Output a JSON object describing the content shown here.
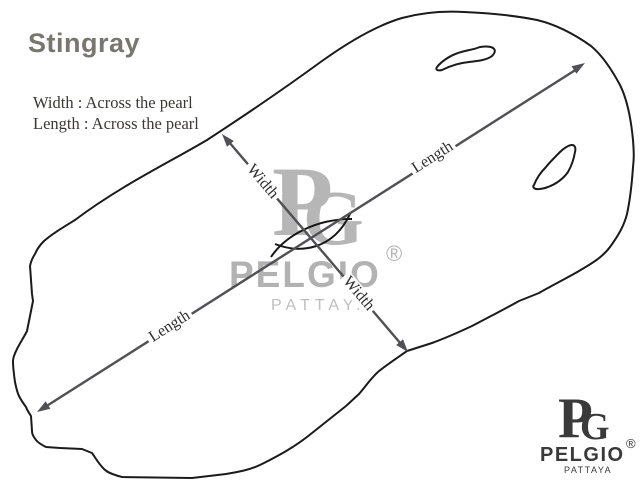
{
  "header": {
    "title": "Stingray"
  },
  "notes": {
    "width_note": "Width : Across the pearl",
    "length_note": "Length : Across the pearl"
  },
  "diagram": {
    "subject": "stingray skin outline with two eye holes and central pearl marking",
    "width_label": "Width",
    "length_label": "Length",
    "arrows": [
      {
        "name": "length",
        "from": [
          37,
          412
        ],
        "to": [
          585,
          63
        ],
        "label_count": 2
      },
      {
        "name": "width",
        "from": [
          222,
          134
        ],
        "to": [
          408,
          352
        ],
        "label_count": 2
      }
    ]
  },
  "watermark": {
    "monogram_p": "P",
    "monogram_g": "G",
    "brand": "PELGIO",
    "registered": "®",
    "city": "PATTAYA"
  },
  "logo": {
    "monogram_p": "P",
    "monogram_g": "G",
    "brand": "PELGIO",
    "registered": "®",
    "city": "PATTAYA"
  },
  "colors": {
    "background": "#ffffff",
    "outline": "#1b1b1b",
    "arrow": "#505055",
    "title": "#77766f",
    "note_text": "#3a3833",
    "watermark_gray": "#b5b5b5",
    "logo_dark": "#3a3a3a"
  }
}
